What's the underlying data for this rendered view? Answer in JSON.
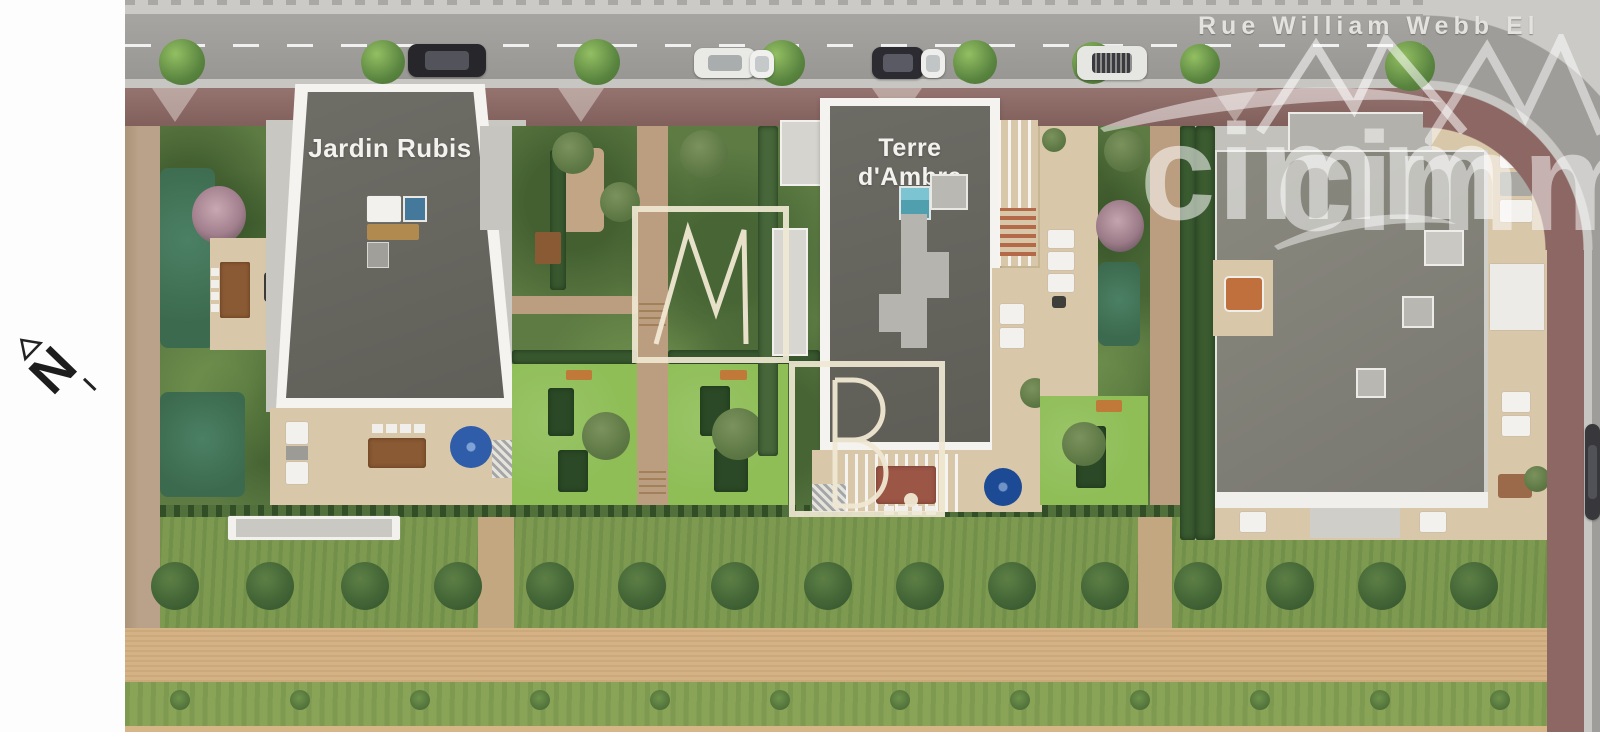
{
  "plan": {
    "street_name": "Rue William Webb El",
    "buildings": [
      {
        "label": "Jardin Rubis"
      },
      {
        "label": "Terre d'Ambre"
      },
      {
        "label": ""
      }
    ],
    "compass_label": "N",
    "watermark": {
      "agency_text": "cimm",
      "monogram_m": "M",
      "monogram_b": "B."
    },
    "colors": {
      "road": "#9f9d99",
      "sidewalk": "#cbcac6",
      "paved_walk_red": "#8c6763",
      "roof_dark": "#6b6a62",
      "roof_light": "#83827a",
      "parapet_white": "#f4f3ef",
      "terrace_beige": "#d9c7a9",
      "lawn_bright": "#8fbe57",
      "garden_green": "#5d7b43",
      "meadow_green": "#7d9a50",
      "path_sand": "#d4b285",
      "parasol_blue": "#2f5da9",
      "watermark_cream": "#efe7d1",
      "watermark_white": "rgba(255,255,255,0.55)"
    },
    "vegetation": {
      "street_trees": [
        {
          "x": 182,
          "y": 62,
          "d": 46
        },
        {
          "x": 383,
          "y": 62,
          "d": 44
        },
        {
          "x": 597,
          "y": 62,
          "d": 46
        },
        {
          "x": 782,
          "y": 63,
          "d": 46
        },
        {
          "x": 975,
          "y": 62,
          "d": 44
        },
        {
          "x": 1093,
          "y": 63,
          "d": 42
        },
        {
          "x": 1200,
          "y": 64,
          "d": 40
        },
        {
          "x": 1410,
          "y": 66,
          "d": 50
        }
      ],
      "meadow_bushes": {
        "y": 586,
        "d": 48,
        "x": [
          175,
          270,
          365,
          458,
          550,
          642,
          735,
          828,
          920,
          1012,
          1105,
          1198,
          1290,
          1382,
          1474
        ]
      },
      "ground_tufts": {
        "y": 700,
        "d": 20,
        "x": [
          180,
          300,
          420,
          540,
          660,
          780,
          900,
          1020,
          1140,
          1260,
          1380,
          1500
        ]
      }
    },
    "cars": [
      {
        "x": 408,
        "y": 44,
        "w": 78,
        "h": 33,
        "body": "#26262b",
        "glass": "#53535b"
      },
      {
        "x": 694,
        "y": 48,
        "w": 62,
        "h": 30,
        "body": "#e9e9e6",
        "glass": "#a9adad"
      },
      {
        "x": 750,
        "y": 50,
        "w": 24,
        "h": 28,
        "body": "#f0f0ee",
        "glass": "#c6c9c9"
      },
      {
        "x": 872,
        "y": 47,
        "w": 52,
        "h": 32,
        "body": "#2b2b31",
        "glass": "#5a5a64"
      },
      {
        "x": 921,
        "y": 49,
        "w": 24,
        "h": 29,
        "body": "#eeeeec",
        "glass": "#c2c5c5"
      },
      {
        "x": 1077,
        "y": 46,
        "w": 70,
        "h": 34,
        "body": "#e6e6e3",
        "glass": "#3a3a40",
        "grid": true
      },
      {
        "x": 1585,
        "y": 424,
        "w": 15,
        "h": 96,
        "body": "#37373c",
        "glass": "#515158"
      }
    ]
  }
}
